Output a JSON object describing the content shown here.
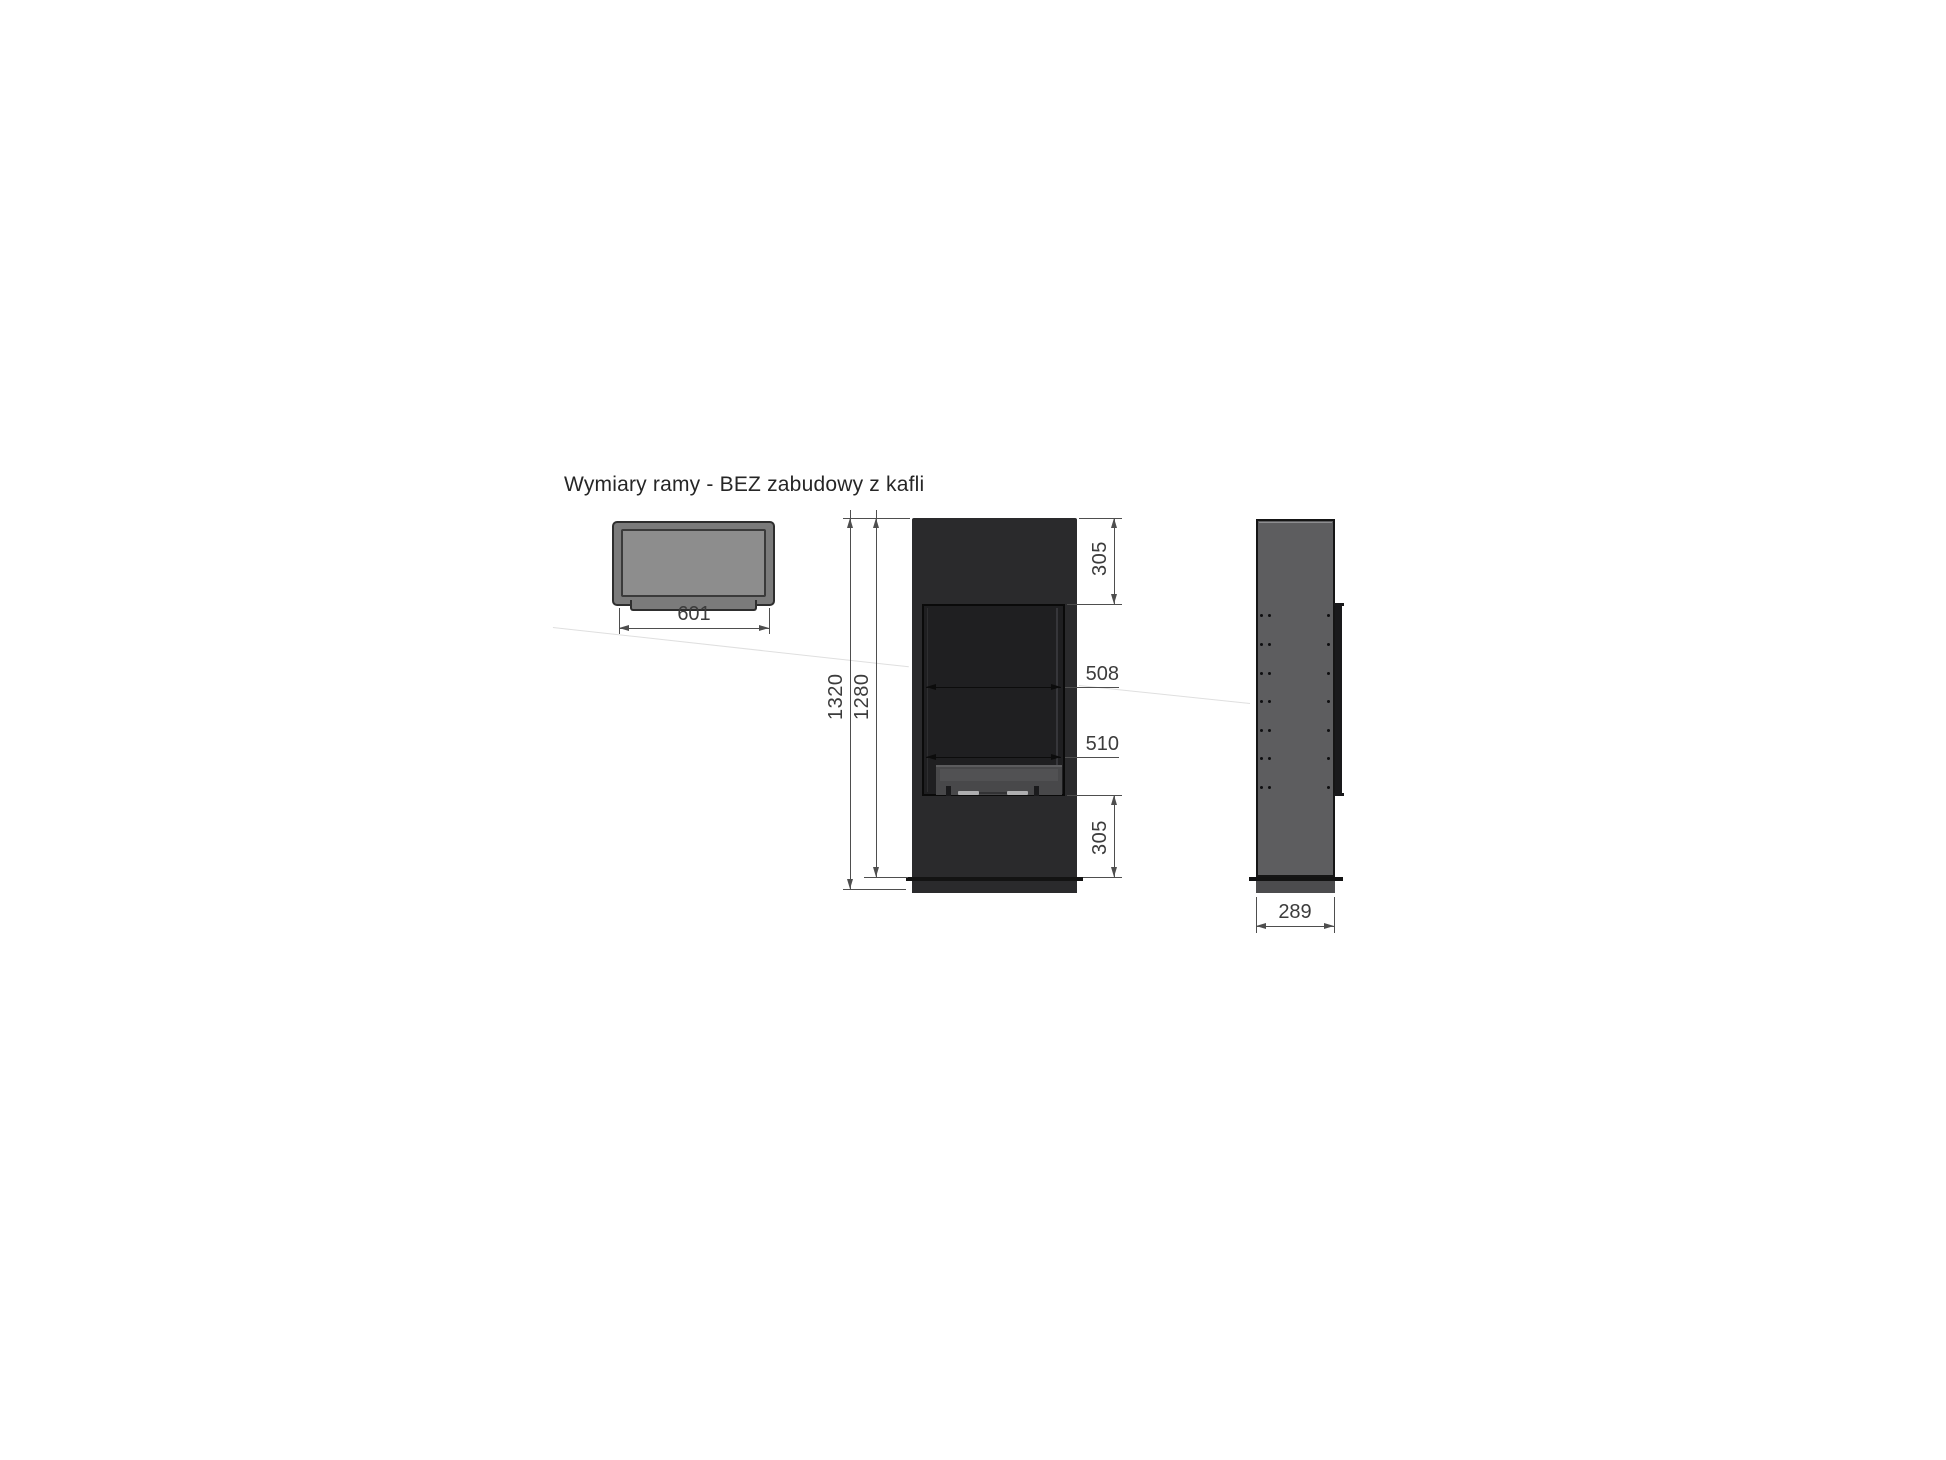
{
  "title": "Wymiary ramy - BEZ zabudowy z kafli",
  "views": {
    "top": {
      "width": "601"
    },
    "front": {
      "overall_height": "1320",
      "frame_height": "1280",
      "top_section": "305",
      "opening_width_upper": "508",
      "opening_width_lower": "510",
      "bottom_section": "305"
    },
    "side": {
      "depth": "289"
    }
  },
  "colors": {
    "line": "#4e4e4e",
    "text": "#3c3c3c",
    "title_text": "#262626",
    "front_body": "#2a2a2c",
    "front_opening": "#1f1f21",
    "outline_dark": "#121212",
    "top_frame": "#7b7b7b",
    "top_inner": "#8d8d8d",
    "side_body": "#5d5d5f",
    "side_plinth": "#4c4c4e",
    "burner": "#48484a",
    "burner_strip": "#aeaeb0"
  }
}
